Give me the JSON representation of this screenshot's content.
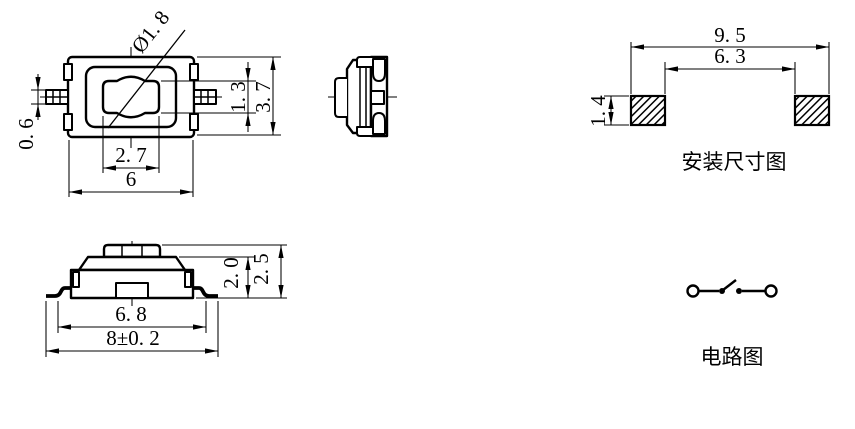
{
  "page": {
    "background": "#ffffff",
    "line_color": "#000000"
  },
  "top_view": {
    "dims": {
      "diameter": "Ø1. 8",
      "lead_height": "0. 6",
      "button_height": "1. 3",
      "body_height": "3. 7",
      "button_width": "2. 7",
      "body_width": "6"
    }
  },
  "front_view": {
    "dims": {
      "body_height": "2. 0",
      "total_height": "2. 5",
      "body_width": "6. 8",
      "total_width": "8±0. 2"
    }
  },
  "mounting_view": {
    "caption": "安装尺寸图",
    "dims": {
      "pad_span_outer": "9. 5",
      "pad_span_inner": "6. 3",
      "pad_height": "1. 4"
    }
  },
  "circuit_view": {
    "caption": "电路图"
  }
}
